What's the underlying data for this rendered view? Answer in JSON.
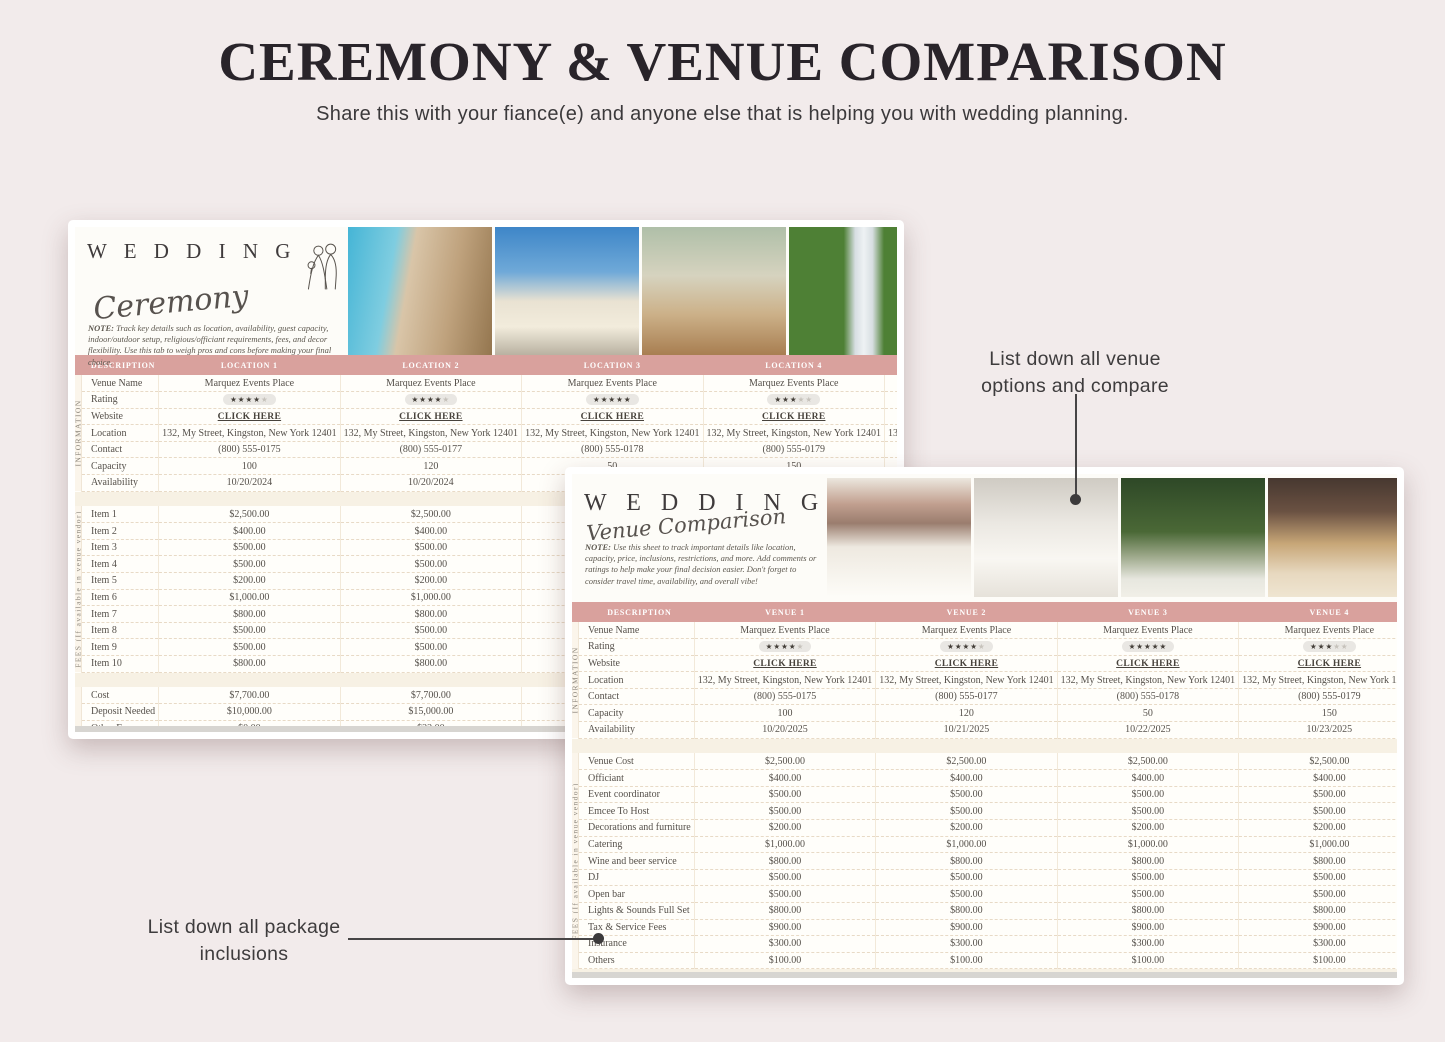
{
  "page": {
    "title": "CEREMONY & VENUE COMPARISON",
    "subtitle": "Share this with your fiance(e) and anyone else that is helping you with wedding planning."
  },
  "annotations": {
    "venue_callout": "List down all venue options and compare",
    "package_callout": "List down all package inclusions"
  },
  "colors": {
    "header_pink": "#d9a19d",
    "header_pink_dark": "#d0938f",
    "sheet_cream": "#fbf5eb",
    "page_background": "#f2ebeb"
  },
  "ceremony": {
    "logo_word": "W E D D I N G",
    "logo_script": "Ceremony",
    "note_label": "NOTE:",
    "note_text": "Track key details such as location, availability, guest capacity, indoor/outdoor setup, religious/officiant requirements, fees, and decor flexibility. Use this tab to weigh pros and cons before making your final choice.",
    "photos": [
      {
        "name": "cathedral-tower-photo",
        "bg": "linear-gradient(100deg,#45b5d6 0%,#7fcde0 30%,#d9c5a8 42%,#bfa27d 70%,#94764f 100%)"
      },
      {
        "name": "white-church-photo",
        "bg": "linear-gradient(180deg,#3e86c8 0%,#6fa9d8 35%,#e9e2d2 58%,#f2ecdc 78%,#b9b1a1 100%)"
      },
      {
        "name": "wedding-arch-photo",
        "bg": "linear-gradient(180deg,#afbfa8 0%,#d6d3bf 38%,#ccb189 68%,#a87e51 100%)"
      },
      {
        "name": "aerial-ceremony-photo",
        "bg": "linear-gradient(90deg,#4e8035 0%,#4e8035 38%,#d7dee2 46%,#eef2f4 52%,#d7dee2 58%,#4e8035 66%,#4e8035 100%)"
      },
      {
        "name": "forest-venue-photo",
        "bg": "linear-gradient(180deg,#3a5a30 0%,#567a3c 50%,#7b9556 100%)"
      }
    ],
    "table": {
      "header": [
        "DESCRIPTION",
        "LOCATION 1",
        "LOCATION 2",
        "LOCATION 3",
        "LOCATION 4",
        "LOCATION 5"
      ],
      "sections": [
        {
          "side_label": "INFORMATION",
          "rows": [
            {
              "label": "Venue Name",
              "values": [
                "Marquez Events Place",
                "Marquez Events Place",
                "Marquez Events Place",
                "Marquez Events Place",
                "Marquez Events Place"
              ]
            },
            {
              "label": "Rating",
              "style": "stars",
              "values": [
                4,
                4,
                5,
                3,
                4
              ]
            },
            {
              "label": "Website",
              "style": "link",
              "values": [
                "CLICK HERE",
                "CLICK HERE",
                "CLICK HERE",
                "CLICK HERE",
                "CLICK HERE"
              ]
            },
            {
              "label": "Location",
              "values": [
                "132, My Street, Kingston, New York 12401",
                "132, My Street, Kingston, New York 12401",
                "132, My Street, Kingston, New York 12401",
                "132, My Street, Kingston, New York 12401",
                "132, My Street, Kingston, New York 12401"
              ]
            },
            {
              "label": "Contact",
              "values": [
                "(800) 555-0175",
                "(800) 555-0177",
                "(800) 555-0178",
                "(800) 555-0179",
                "(800) 555-0180"
              ]
            },
            {
              "label": "Capacity",
              "values": [
                "100",
                "120",
                "50",
                "150",
                "100"
              ]
            },
            {
              "label": "Availability",
              "values": [
                "10/20/2024",
                "10/20/2024",
                "",
                "",
                ""
              ]
            }
          ]
        },
        {
          "side_label": "FEES (If available in venue vendor)",
          "rows": [
            {
              "label": "Item 1",
              "values": [
                "$2,500.00",
                "$2,500.00",
                "",
                "",
                ""
              ]
            },
            {
              "label": "Item 2",
              "values": [
                "$400.00",
                "$400.00",
                "",
                "",
                ""
              ]
            },
            {
              "label": "Item 3",
              "values": [
                "$500.00",
                "$500.00",
                "",
                "",
                ""
              ]
            },
            {
              "label": "Item 4",
              "values": [
                "$500.00",
                "$500.00",
                "",
                "",
                ""
              ]
            },
            {
              "label": "Item 5",
              "values": [
                "$200.00",
                "$200.00",
                "",
                "",
                ""
              ]
            },
            {
              "label": "Item 6",
              "values": [
                "$1,000.00",
                "$1,000.00",
                "",
                "",
                ""
              ]
            },
            {
              "label": "Item 7",
              "values": [
                "$800.00",
                "$800.00",
                "",
                "",
                ""
              ]
            },
            {
              "label": "Item 8",
              "values": [
                "$500.00",
                "$500.00",
                "",
                "",
                ""
              ]
            },
            {
              "label": "Item 9",
              "values": [
                "$500.00",
                "$500.00",
                "",
                "",
                ""
              ]
            },
            {
              "label": "Item 10",
              "values": [
                "$800.00",
                "$800.00",
                "",
                "",
                ""
              ]
            }
          ]
        },
        {
          "side_label": "",
          "rows": [
            {
              "label": "Cost",
              "values": [
                "$7,700.00",
                "$7,700.00",
                "",
                "",
                ""
              ]
            },
            {
              "label": "Deposit Needed",
              "values": [
                "$10,000.00",
                "$15,000.00",
                "",
                "",
                ""
              ]
            },
            {
              "label": "Other Fees",
              "values": [
                "$0.00",
                "$22.00",
                "",
                "",
                ""
              ]
            }
          ]
        }
      ]
    }
  },
  "venue": {
    "logo_word": "W E D D I N G",
    "logo_script": "Venue Comparison",
    "note_label": "NOTE:",
    "note_text": "Use this sheet to track important details like location, capacity, price, inclusions, restrictions, and more. Add comments or ratings to help make your final decision easier. Don't forget to consider travel time, availability, and overall vibe!",
    "photos": [
      {
        "name": "banquet-hall-photo",
        "bg": "linear-gradient(180deg,#ece7de 0%,#c19f8f 22%,#9a7d6e 38%,#eee9e0 58%,#fdfcf8 100%)"
      },
      {
        "name": "floral-tables-photo",
        "bg": "linear-gradient(180deg,#cfcbc3 0%,#ebe8e2 38%,#f9f7f2 68%,#e6e2da 100%)"
      },
      {
        "name": "garden-ceremony-photo",
        "bg": "linear-gradient(180deg,#2e4827 0%,#4a6836 45%,#9aa687 65%,#e7e7df 85%,#f1efe7 100%)"
      },
      {
        "name": "gold-ballroom-photo",
        "bg": "linear-gradient(180deg,#473830 0%,#6a5142 28%,#c7a677 55%,#e7d8bf 80%,#efe5d1 100%)"
      },
      {
        "name": "bright-hall-photo",
        "bg": "linear-gradient(180deg,#f4f0e7 0%,#eee7d9 40%,#dfd3bb 70%,#d7c7a7 100%)"
      }
    ],
    "table": {
      "header": [
        "DESCRIPTION",
        "VENUE 1",
        "VENUE 2",
        "VENUE 3",
        "VENUE 4",
        "VENUE 5"
      ],
      "sections": [
        {
          "side_label": "INFORMATION",
          "rows": [
            {
              "label": "Venue Name",
              "values": [
                "Marquez Events Place",
                "Marquez Events Place",
                "Marquez Events Place",
                "Marquez Events Place",
                "Marquez Events Place"
              ]
            },
            {
              "label": "Rating",
              "style": "stars",
              "values": [
                4,
                4,
                5,
                3,
                4
              ]
            },
            {
              "label": "Website",
              "style": "link",
              "values": [
                "CLICK HERE",
                "CLICK HERE",
                "CLICK HERE",
                "CLICK HERE",
                "CLICK HERE"
              ]
            },
            {
              "label": "Location",
              "values": [
                "132, My Street, Kingston, New York 12401",
                "132, My Street, Kingston, New York 12401",
                "132, My Street, Kingston, New York 12401",
                "132, My Street, Kingston, New York 12401",
                "132, My Street, Kingston, New York 12401"
              ]
            },
            {
              "label": "Contact",
              "values": [
                "(800) 555-0175",
                "(800) 555-0177",
                "(800) 555-0178",
                "(800) 555-0179",
                "(800) 555-0180"
              ]
            },
            {
              "label": "Capacity",
              "values": [
                "100",
                "120",
                "50",
                "150",
                "100"
              ]
            },
            {
              "label": "Availability",
              "values": [
                "10/20/2025",
                "10/21/2025",
                "10/22/2025",
                "10/23/2025",
                "10/24/2025"
              ]
            }
          ]
        },
        {
          "side_label": "FEES (If available in venue vendor)",
          "rows": [
            {
              "label": "Venue Cost",
              "values": [
                "$2,500.00",
                "$2,500.00",
                "$2,500.00",
                "$2,500.00",
                "$2,500.00"
              ]
            },
            {
              "label": "Officiant",
              "values": [
                "$400.00",
                "$400.00",
                "$400.00",
                "$400.00",
                "$400.00"
              ]
            },
            {
              "label": "Event coordinator",
              "values": [
                "$500.00",
                "$500.00",
                "$500.00",
                "$500.00",
                "$500.00"
              ]
            },
            {
              "label": "Emcee To Host",
              "values": [
                "$500.00",
                "$500.00",
                "$500.00",
                "$500.00",
                "$500.00"
              ]
            },
            {
              "label": "Decorations and furniture",
              "values": [
                "$200.00",
                "$200.00",
                "$200.00",
                "$200.00",
                "$200.00"
              ]
            },
            {
              "label": "Catering",
              "values": [
                "$1,000.00",
                "$1,000.00",
                "$1,000.00",
                "$1,000.00",
                "$1,000.00"
              ]
            },
            {
              "label": "Wine and beer service",
              "values": [
                "$800.00",
                "$800.00",
                "$800.00",
                "$800.00",
                "$800.00"
              ]
            },
            {
              "label": "DJ",
              "values": [
                "$500.00",
                "$500.00",
                "$500.00",
                "$500.00",
                "$500.00"
              ]
            },
            {
              "label": "Open bar",
              "values": [
                "$500.00",
                "$500.00",
                "$500.00",
                "$500.00",
                "$500.00"
              ]
            },
            {
              "label": "Lights & Sounds Full Set",
              "values": [
                "$800.00",
                "$800.00",
                "$800.00",
                "$800.00",
                "$800.00"
              ]
            },
            {
              "label": "Tax & Service Fees",
              "values": [
                "$900.00",
                "$900.00",
                "$900.00",
                "$900.00",
                "$900.00"
              ]
            },
            {
              "label": "Insurance",
              "values": [
                "$300.00",
                "$300.00",
                "$300.00",
                "$300.00",
                "$300.00"
              ]
            },
            {
              "label": "Others",
              "values": [
                "$100.00",
                "$100.00",
                "$100.00",
                "$100.00",
                "$100.00"
              ]
            }
          ]
        }
      ]
    }
  }
}
